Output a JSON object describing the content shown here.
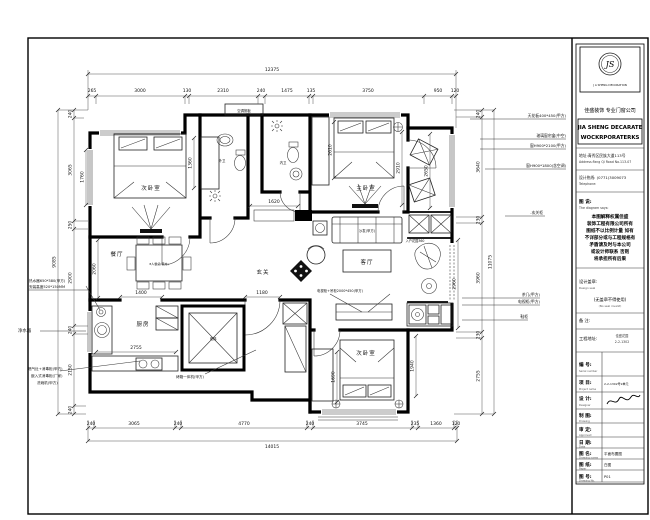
{
  "plan": {
    "dims": {
      "top_total": "12375",
      "top": [
        "265",
        "3000",
        "130",
        "2310",
        "240",
        "1475",
        "135",
        "3750",
        "950",
        "120"
      ],
      "bottom": [
        "240",
        "3065",
        "240",
        "4770",
        "240",
        "3745",
        "235",
        "1360",
        "120"
      ],
      "bottom_total": "14015",
      "left": [
        "240",
        "3065",
        "250",
        "2900",
        "240",
        "2150",
        "240"
      ],
      "left_total": "9085",
      "right": [
        "240",
        "3640",
        "230",
        "3960",
        "230",
        "2755"
      ],
      "right_total": "11075",
      "inner": {
        "wardrobe_tl": "1760",
        "dining_h": "2060",
        "closet_w": "1360",
        "master_bed": "2610",
        "master_r": "2910",
        "balcony": "2650",
        "garden": "2960",
        "hall": "1620",
        "entry_w": "1180",
        "kitchen_w": "1400",
        "kitchen_counter": "2755",
        "wardrobe_br": "1690",
        "bed_br": "1940"
      }
    },
    "rooms": {
      "bedroom_tl": "次卧室",
      "master": "主卧室",
      "bath_outer": "外卫",
      "bath_inner": "内卫",
      "living": "客厅",
      "dining": "餐厅",
      "entry": "玄关",
      "kitchen": "厨房",
      "bedroom_br": "次卧室",
      "elevator": "电梯",
      "sofa": "沙发(甲方)",
      "dining_table": "8人餐桌(甲方)",
      "ac_shelf": "空调搁板",
      "garden": "入户花园360"
    },
    "ann": {
      "r1": "天花板400*450(甲方)",
      "r2": "玻璃窗帘盒(中空)",
      "r3": "窗H900*2100(甲方)",
      "r4": "窗H900*1800(含空调)",
      "r5": "-玄关柜",
      "r6": "茶几(甲方)",
      "r7": "电视柜(甲方)",
      "r8": "鞋柜",
      "l1": "热水器650*380(甲方)",
      "l2": "安装高度520*150MM",
      "l3": "净水器",
      "l4": "燃气灶+消毒柜(甲方)",
      "l5": "嵌入式消毒柜(厂家)",
      "l6": "洗碗机(甲方)",
      "oven": "烤箱一体机(甲方)",
      "tv": "电视柜+吊柜2000*450(甲方)"
    }
  },
  "titleblock": {
    "logo_initials": "JS",
    "logo_caption": "J A SHENG DECORATION",
    "company_cn": "佳盛装饰 专业门窗公司",
    "company_en1": "JIA SHENG DECARATE",
    "company_en2": "WOCKRPORATERKS",
    "address_cn": "地址:青秀区民族大道113号",
    "address_en": "Address:Fang Qi Road No.113-07",
    "tel_cn": "设计热线: (0771)3009073",
    "tel_en": "Telephone:",
    "notes_title": "图 说:",
    "notes_sub": "The diagram says:",
    "notes": [
      "本图解释权属佳盛",
      "装饰工程有限公司所有",
      "图纸不以比例计量 如有",
      "不详部分或与工程规格有",
      "矛盾请及时与本公司",
      "或设计师联系 否则",
      "将承担所有后果"
    ],
    "seal_label": "设计盖章:",
    "seal_sub": "Design seal",
    "seal_warn": "(无盖章不得使用)",
    "seal_warn_sub": "(No seal invalid)",
    "remark_label": "备 注:",
    "site_label": "工程地址:",
    "site_v1": "佳盛花园",
    "site_v2": "2-2-1302",
    "rows": [
      {
        "label": "编 号:",
        "sub": "Serial number",
        "value": ""
      },
      {
        "label": "项 目:",
        "sub": "Project name",
        "value": "2-2-1302号2单元"
      },
      {
        "label": "设 计:",
        "sub": "Designer",
        "value": ""
      },
      {
        "label": "制 图:",
        "sub": "Drawing",
        "value": ""
      },
      {
        "label": "审 定:",
        "sub": "Approved",
        "value": ""
      },
      {
        "label": "日 期:",
        "sub": "Date",
        "value": ""
      },
      {
        "label": "图 名:",
        "sub": "Drawing name",
        "value": "平面布置图"
      },
      {
        "label": "图 纸:",
        "sub": "Paper",
        "value": "白图"
      },
      {
        "label": "图 号:",
        "sub": "Drawing No.",
        "value": "P01"
      }
    ]
  }
}
